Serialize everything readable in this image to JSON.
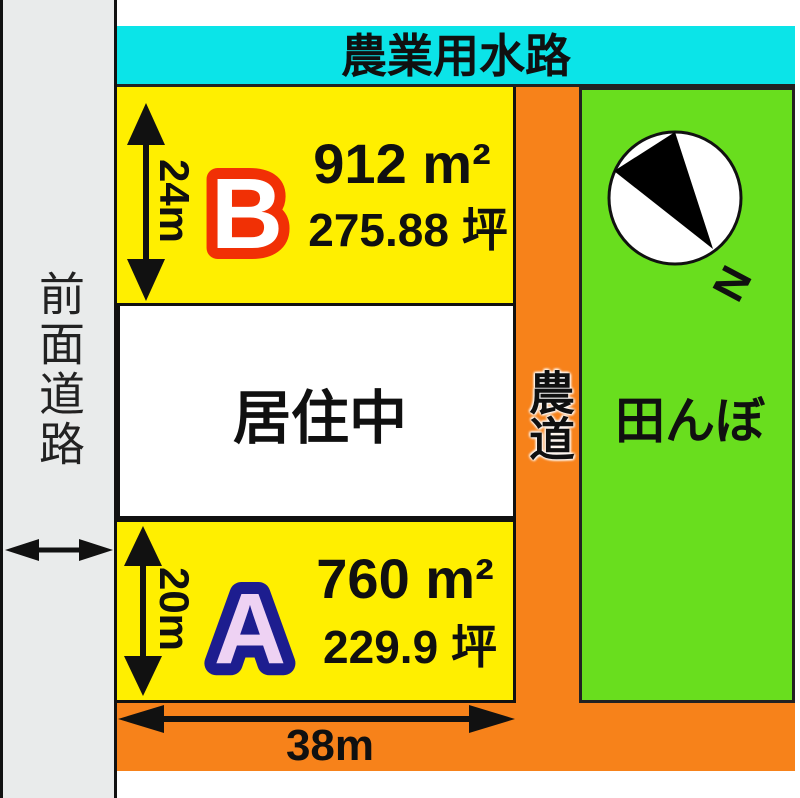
{
  "diagram_title": "land-plot-sales-diagram",
  "front_road": {
    "label": "前面道路"
  },
  "waterway": {
    "label": "農業用水路"
  },
  "plot_b": {
    "id": "B",
    "area_m2": "912 m²",
    "area_tsubo": "275.88 坪",
    "depth": "24m",
    "width": "38m"
  },
  "occupied": {
    "label": "居住中"
  },
  "plot_a": {
    "id": "A",
    "area_m2": "760 m²",
    "area_tsubo": "229.9 坪",
    "depth": "20m",
    "width": "38m"
  },
  "farm_road": {
    "label": "農道"
  },
  "rice_paddy": {
    "label": "田んぼ"
  },
  "compass": {
    "label": "N"
  },
  "colors": {
    "waterway_cyan": "#0be4e8",
    "plot_yellow": "#ffef00",
    "road_orange": "#f7821a",
    "paddy_green": "#69de1e",
    "front_road_gray": "#e9ebeb",
    "plot_b_letter": "#f13005",
    "plot_a_letter": "#1d1d8f",
    "plot_a_letter_fill": "#eed2f3",
    "line_black": "#111111"
  }
}
